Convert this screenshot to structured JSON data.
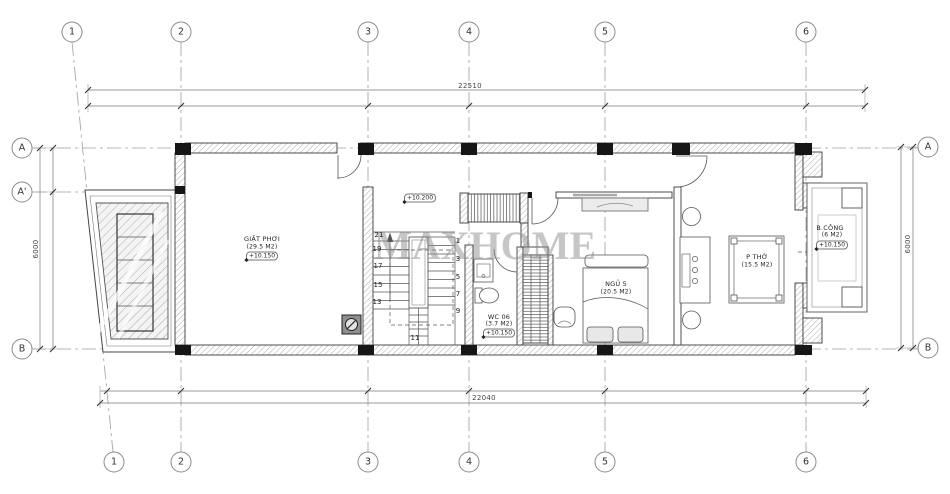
{
  "watermark": "MAXHOME",
  "grid": {
    "top": [
      "1",
      "2",
      "3",
      "4",
      "5",
      "6"
    ],
    "bottom": [
      "1",
      "2",
      "3",
      "4",
      "5",
      "6"
    ],
    "left": [
      "A",
      "A'",
      "B"
    ],
    "right": [
      "A",
      "B"
    ]
  },
  "dims": {
    "top": "22510",
    "bottom": "22040",
    "left": "6000",
    "right": "6000"
  },
  "rooms": {
    "laundry": {
      "name": "GIẶT PHƠI",
      "area": "(29.5 M2)",
      "elev": "+10.150"
    },
    "hall": {
      "elev": "+10.200"
    },
    "wc": {
      "name": "WC 06",
      "area": "(3.7 M2)",
      "elev": "+10.150"
    },
    "bedroom": {
      "name": "NGỦ 5",
      "area": "(20.5 M2)"
    },
    "worship": {
      "name": "P THỜ",
      "area": "(15.5 M2)"
    },
    "balcony": {
      "name": "B.CÔNG",
      "area": "(6 M2)",
      "elev": "+10.150"
    }
  },
  "stairs": {
    "left": [
      "21",
      "19",
      "17",
      "15",
      "13"
    ],
    "right": [
      "1",
      "3",
      "5",
      "7",
      "9"
    ],
    "bottom": "11"
  },
  "colors": {
    "wall_line": "#3a3a3a",
    "grid_line": "#9f9f9f",
    "column_fill": "#161616",
    "hatch": "#adadad",
    "watermark": "#8f8f8f"
  }
}
